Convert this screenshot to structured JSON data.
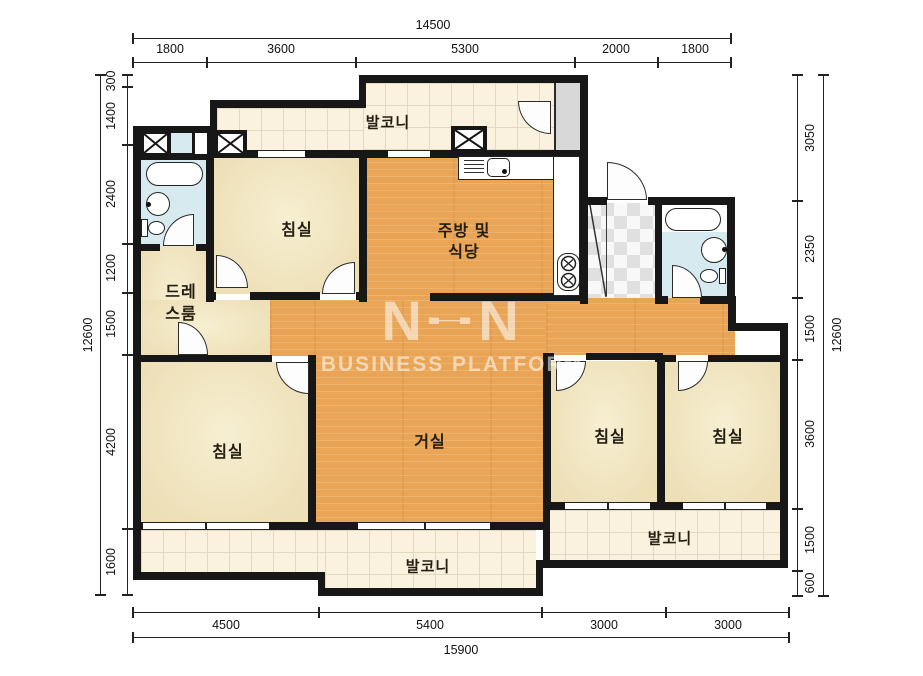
{
  "watermark": {
    "logo_n1": "N",
    "logo_h": "H",
    "logo_n2": "N",
    "subtitle": "BUSINESS PLATFORM"
  },
  "rooms": {
    "balcony_top": "발코니",
    "bedroom_top_left": "침실",
    "kitchen_line1": "주방 및",
    "kitchen_line2": "식당",
    "dressroom_line1": "드레",
    "dressroom_line2": "스룸",
    "living": "거실",
    "bedroom_bottom_left": "침실",
    "bedroom_right_1": "침실",
    "bedroom_right_2": "침실",
    "balcony_bottom": "발코니",
    "balcony_right": "발코니"
  },
  "dimensions": {
    "top": {
      "total": "14500",
      "segments": [
        "1800",
        "3600",
        "5300",
        "2000",
        "1800"
      ]
    },
    "bottom": {
      "total": "15900",
      "segments": [
        "4500",
        "5400",
        "3000",
        "3000"
      ]
    },
    "left": {
      "total": "12600",
      "segments": [
        "300",
        "1400",
        "2400",
        "1200",
        "1500",
        "4200",
        "1600"
      ]
    },
    "right": {
      "total": "12600",
      "segments": [
        "3050",
        "2350",
        "1500",
        "3600",
        "1500",
        "600"
      ]
    }
  },
  "colors": {
    "wall": "#171717",
    "wood_floor": "#e9a455",
    "bedroom_floor": "#f0e4c0",
    "balcony_tile": "#faf2df",
    "bathroom": "#d7eaf0",
    "shaft_gray": "#d8d8d8"
  }
}
